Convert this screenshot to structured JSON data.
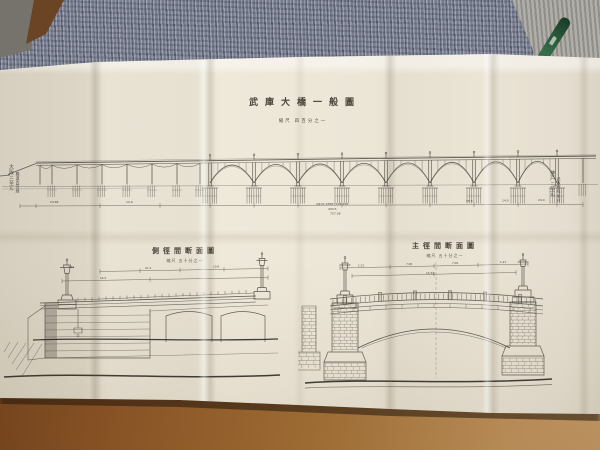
{
  "photo": {
    "surface": {
      "wood_dark": "#6e3f1b",
      "wood_light": "#b68a55"
    },
    "fabric": {
      "knit_base": "#8b90a1",
      "knit_light": "#a3a19b"
    },
    "pen_color": "#2c5a3c",
    "paper_color": "#e9e3d4",
    "ink_color": "#4b463e"
  },
  "drawing": {
    "title": "武庫大橋一般圖",
    "scale": "縮尺 四百分之一",
    "left_route_label": "大阪ニ至ル",
    "left_route_sublabel": "縣道西宮線",
    "right_route_label": "神戸ニ至ル",
    "right_route_sublabel": "武庫郡鳴尾村",
    "elevation_dims": [
      "24.84",
      "14.0",
      "4@31.5565=126.226",
      "430.5",
      "727.38",
      "28.5",
      "14.0",
      "24.0"
    ],
    "section_left": {
      "title": "側徑間断面圖",
      "scale": "縮尺 五十分之一",
      "dims": [
        "2.42",
        "21.2",
        "10.6",
        "14.0"
      ]
    },
    "section_right": {
      "title": "主徑間断面圖",
      "scale": "縮尺 五十分之一",
      "dims": [
        "1.21",
        "7.00",
        "7.00",
        "1.21",
        "14.54"
      ]
    }
  }
}
